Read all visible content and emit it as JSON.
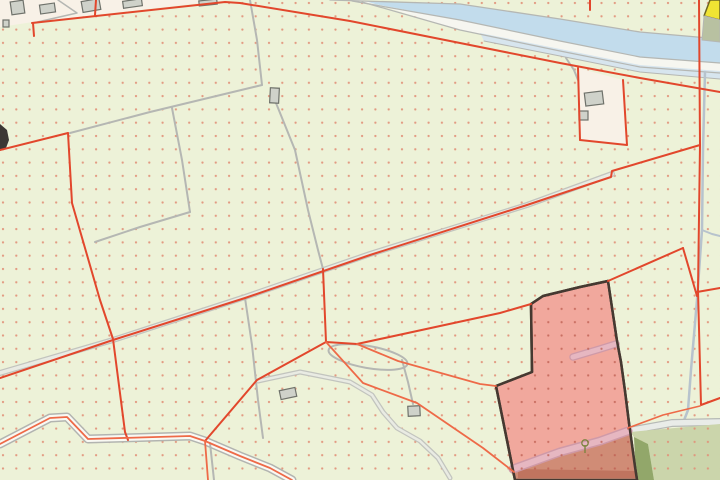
{
  "map": {
    "kind": "cadastral-map-view",
    "width": 720,
    "height": 480,
    "palette": {
      "bg": "#edf2d8",
      "dot": "#e29078",
      "dot_dark": "#bd5c4e",
      "red": "#e2472c",
      "red_thin": "#ee6a48",
      "gray": "#b5b7b3",
      "road_edge": "#c2c4be",
      "road_fill": "#e9ebe3",
      "canal": "#c2dcec",
      "canal2": "#d7e5ee",
      "towpath": "#f6f6f0",
      "farmyard": "#f8f1e7",
      "building_fill": "#cfd2ca",
      "building_edge": "#6f726b",
      "yellow": "#f0e433",
      "yellow_edge": "#6c6624",
      "olive": "#b8c1a1",
      "pink": "#f1a89d",
      "pink_edge": "#453931",
      "terracotta": "#d08c76",
      "terracotta_dark": "#bb6c58",
      "mauve": "#e6b7c1",
      "mauve_edge": "#cf9aa8",
      "pale_path": "#e9ece8",
      "pale_path_edge": "#b6bab6",
      "ditch": "#b7c3cd",
      "sage": "#cbd5ab",
      "sage_dark": "#92a76a",
      "stream_fill": "#f9f9f3",
      "stream_edge": "#b2b4b0",
      "black_feature": "#3b3734",
      "tree": "#7d8440"
    },
    "dot_grid": {
      "spacing": 13.3,
      "radius": 1.15
    },
    "layers": [
      {
        "name": "farmyard-top-left",
        "kind": "polygon",
        "pts": "0,0 228,0 33,22 0,27",
        "fill": "farmyard"
      },
      {
        "name": "farmyard-top-right",
        "kind": "polygon",
        "pts": "578,68 623,80 627,145 580,141",
        "fill": "farmyard"
      },
      {
        "name": "canal-water",
        "kind": "polygon",
        "pts": "330,0 460,4 560,19 640,32 720,39 720,63 640,57 560,41 460,20 352,0",
        "fill": "canal"
      },
      {
        "name": "canal-towpath",
        "kind": "polygon",
        "pts": "352,0 460,20 560,41 640,57 720,63 720,73 640,67 560,51 460,30 362,0",
        "fill": "towpath"
      },
      {
        "name": "canal-secondary-water",
        "kind": "polygon",
        "pts": "480,33 560,49 640,65 720,71 720,79 640,72 560,56 484,41",
        "fill": "canal2"
      },
      {
        "name": "canal-bank-line-north",
        "kind": "polyline",
        "pts": "330,0 460,4 560,19 640,32 720,39",
        "stroke": "gray",
        "w": 1.3
      },
      {
        "name": "canal-bank-line-south",
        "kind": "polyline",
        "pts": "352,1 460,20 560,41 640,57 720,63",
        "stroke": "gray",
        "w": 1.2
      },
      {
        "name": "towpath-edge-line",
        "kind": "polyline",
        "pts": "362,2 460,30 560,51 640,67 720,73",
        "stroke": "gray",
        "w": 1.2
      },
      {
        "name": "secondary-bank-line",
        "kind": "polyline",
        "pts": "484,41 560,56 640,72 720,79",
        "stroke": "gray",
        "w": 1
      },
      {
        "name": "road-main-casing",
        "kind": "polyline",
        "pts": "0,373 113,340 245,297 370,254 527,205 612,174",
        "stroke": "road_edge",
        "w": 6
      },
      {
        "name": "road-main",
        "kind": "polyline",
        "pts": "0,373 113,340 245,297 370,254 527,205 612,174",
        "stroke": "road_fill",
        "w": 3.5
      },
      {
        "name": "field-path-branch",
        "kind": "polyline",
        "pts": "245,298 252,345 258,400 263,438",
        "stroke": "gray",
        "w": 2
      },
      {
        "name": "field-line-diagonal",
        "kind": "polyline",
        "pts": "70,133 150,112 262,85",
        "stroke": "gray",
        "w": 2
      },
      {
        "name": "field-line-north",
        "kind": "polyline",
        "pts": "250,0 257,40 262,85",
        "stroke": "gray",
        "w": 2
      },
      {
        "name": "field-line-curve",
        "kind": "polyline",
        "pts": "276,103 295,150 308,210 318,250 323,269",
        "stroke": "gray",
        "w": 2
      },
      {
        "name": "field-line-vertical",
        "kind": "polyline",
        "pts": "172,108 182,160 190,212",
        "stroke": "gray",
        "w": 2
      },
      {
        "name": "field-line-southwest",
        "kind": "polyline",
        "pts": "190,212 140,227 95,242",
        "stroke": "gray",
        "w": 2
      },
      {
        "name": "farm-access-path",
        "kind": "polyline",
        "pts": "566,58 574,70 578,80",
        "stroke": "gray",
        "w": 2
      },
      {
        "name": "yard-path-line",
        "kind": "polyline",
        "pts": "58,0 77,13 33,23",
        "stroke": "gray",
        "w": 1.5
      },
      {
        "name": "loop-path",
        "kind": "ellipse",
        "cx": 368,
        "cy": 357,
        "rx": 40,
        "ry": 11,
        "rot": 10,
        "stroke": "gray",
        "w": 2
      },
      {
        "name": "s-path-casing",
        "kind": "polyline",
        "pts": "258,381 300,372 350,382 372,395 383,412 397,428 420,441 438,458 450,478",
        "stroke": "road_edge",
        "w": 5
      },
      {
        "name": "s-path",
        "kind": "polyline",
        "pts": "258,381 300,372 350,382 372,395 383,412 397,428 420,441 438,458 450,478",
        "stroke": "road_fill",
        "w": 2.5
      },
      {
        "name": "loop-branch-path",
        "kind": "polyline",
        "pts": "402,360 408,382 413,404",
        "stroke": "gray",
        "w": 2
      },
      {
        "name": "stream-casing",
        "kind": "polyline",
        "pts": "0,444 50,418 67,417 88,439 190,436 205,441 240,456 270,468 292,480",
        "stroke": "stream_edge",
        "w": 9
      },
      {
        "name": "stream",
        "kind": "polyline",
        "pts": "0,444 50,418 67,417 88,439 190,436 205,441 240,456 270,468 292,480",
        "stroke": "stream_fill",
        "w": 6
      },
      {
        "name": "stream-branch-path",
        "kind": "polyline",
        "pts": "210,443 214,480",
        "stroke": "gray",
        "w": 2
      },
      {
        "name": "ditch-east",
        "kind": "polyline",
        "pts": "705,72 703,150 702,230 697,300 691,370 688,410 683,423",
        "stroke": "ditch",
        "w": 2.5
      },
      {
        "name": "ditch-east-branch",
        "kind": "polyline",
        "pts": "702,230 712,234 720,236",
        "stroke": "ditch",
        "w": 2
      },
      {
        "name": "pale-path-casing",
        "kind": "polyline",
        "pts": "628,431 672,423 720,422",
        "stroke": "pale_path_edge",
        "w": 8
      },
      {
        "name": "pale-path",
        "kind": "polyline",
        "pts": "628,431 672,423 720,422",
        "stroke": "pale_path",
        "w": 5.5
      },
      {
        "name": "sage-area",
        "kind": "polygon",
        "pts": "630,432 720,424 720,480 654,480 648,444 634,437",
        "fill": "sage",
        "dots": "light"
      },
      {
        "name": "tree-wedge",
        "kind": "polygon",
        "pts": "634,437 648,444 654,480 636,480",
        "fill": "sage_dark"
      },
      {
        "name": "selected-parcel",
        "kind": "polygon",
        "pts": "531,304 543,296 580,287 608,281 617,341 621,362 625,391 629,423 635,467 637,480 515,480 496,386 532,372",
        "fill": "pink",
        "stroke": "pink_edge",
        "sw": 2.5,
        "interactable": true
      },
      {
        "name": "parcel-south-area",
        "kind": "polygon",
        "pts": "511,472 560,455 603,443 629,432 635,467 637,480 515,480",
        "fill": "terracotta"
      },
      {
        "name": "parcel-south-dark-strip",
        "kind": "polygon",
        "pts": "518,469 636,471 636,478 518,478",
        "fill": "terracotta_dark",
        "op": 0.75
      },
      {
        "name": "parcel-road-casing",
        "kind": "polyline",
        "pts": "513,469 560,452 600,441 628,431",
        "stroke": "mauve_edge",
        "w": 9
      },
      {
        "name": "parcel-road",
        "kind": "polyline",
        "pts": "513,469 560,452 600,441 628,431",
        "stroke": "mauve",
        "w": 6
      },
      {
        "name": "parcel-drive-casing",
        "kind": "polyline",
        "pts": "573,357 600,349 616,344",
        "stroke": "mauve_edge",
        "w": 7.5
      },
      {
        "name": "parcel-drive",
        "kind": "polyline",
        "pts": "573,357 600,349 616,344",
        "stroke": "mauve",
        "w": 5
      },
      {
        "name": "selected-parcel-dots",
        "kind": "polygon",
        "pts": "531,304 543,296 580,287 608,281 617,341 621,362 625,391 629,423 635,467 637,480 515,480 496,386 532,372",
        "fill": "@dotsDark",
        "stroke": "pink_edge",
        "sw": 2.5
      },
      {
        "name": "tree-symbol",
        "kind": "tree",
        "x": 585,
        "y": 447
      },
      {
        "name": "black-structure",
        "kind": "polygon",
        "pts": "0,124 7,130 9,140 6,148 0,151",
        "fill": "black_feature"
      },
      {
        "name": "building",
        "kind": "rect",
        "x": 11,
        "y": 1,
        "w": 13,
        "h": 13,
        "rot": -8
      },
      {
        "name": "building",
        "kind": "rect",
        "x": 40,
        "y": 4,
        "w": 15,
        "h": 9,
        "rot": -8
      },
      {
        "name": "building",
        "kind": "rect",
        "x": 3,
        "y": 20,
        "w": 6,
        "h": 7,
        "rot": 0
      },
      {
        "name": "building",
        "kind": "rect",
        "x": 82,
        "y": 0,
        "w": 18,
        "h": 11,
        "rot": -10
      },
      {
        "name": "building",
        "kind": "rect",
        "x": 123,
        "y": 0,
        "w": 19,
        "h": 7,
        "rot": -8
      },
      {
        "name": "building",
        "kind": "rect",
        "x": 199,
        "y": 0,
        "w": 18,
        "h": 5,
        "rot": -6
      },
      {
        "name": "building",
        "kind": "rect",
        "x": 270,
        "y": 88,
        "w": 9,
        "h": 15,
        "rot": 3
      },
      {
        "name": "building",
        "kind": "rect",
        "x": 585,
        "y": 92,
        "w": 18,
        "h": 13,
        "rot": -7
      },
      {
        "name": "building",
        "kind": "rect",
        "x": 579,
        "y": 111,
        "w": 9,
        "h": 9,
        "rot": 0
      },
      {
        "name": "building",
        "kind": "rect",
        "x": 408,
        "y": 406,
        "w": 12,
        "h": 10,
        "rot": -3
      },
      {
        "name": "building",
        "kind": "rect",
        "x": 280,
        "y": 389,
        "w": 16,
        "h": 9,
        "rot": -12
      },
      {
        "name": "parcel-boundary-canal-south",
        "kind": "polyline",
        "pts": "32,23 225,2 240,3 350,21 460,43 560,63 640,78 720,92",
        "stroke": "red",
        "w": 2
      },
      {
        "name": "parcel-boundary-top-stub",
        "kind": "polyline",
        "pts": "96,0 95,15",
        "stroke": "red",
        "w": 2
      },
      {
        "name": "parcel-boundary-west-in",
        "kind": "polyline",
        "pts": "0,150 68,133",
        "stroke": "red",
        "w": 2
      },
      {
        "name": "parcel-boundary-west-long",
        "kind": "polyline",
        "pts": "68,133 72,203 100,300 113,339 125,432 128,440",
        "stroke": "red",
        "w": 2
      },
      {
        "name": "parcel-boundary-yard-stub",
        "kind": "polyline",
        "pts": "33,23 34,36",
        "stroke": "red",
        "w": 2
      },
      {
        "name": "parcel-boundary-road-long",
        "kind": "polyline",
        "pts": "0,378 113,340 245,298 370,255 527,205 611,177 612,171 700,145",
        "stroke": "red",
        "w": 2
      },
      {
        "name": "parcel-boundary-mid-vertical",
        "kind": "polyline",
        "pts": "323,269 326,342",
        "stroke": "red",
        "w": 2
      },
      {
        "name": "parcel-boundary-to-stream",
        "kind": "polyline",
        "pts": "326,342 257,380 205,441",
        "stroke": "red",
        "w": 2
      },
      {
        "name": "parcel-boundary-to-parcel-top",
        "kind": "polyline",
        "pts": "326,342 357,344 500,313 531,304",
        "stroke": "red",
        "w": 2
      },
      {
        "name": "parcel-boundary-to-parcel-corner",
        "kind": "polyline",
        "pts": "357,344 398,361 480,384 496,386",
        "stroke": "red_thin",
        "w": 1.8
      },
      {
        "name": "parcel-boundary-diagonal-south",
        "kind": "polyline",
        "pts": "326,342 363,383 417,403 483,448 514,472",
        "stroke": "red_thin",
        "w": 1.8
      },
      {
        "name": "farmyard-boundary-west",
        "kind": "polyline",
        "pts": "578,68 580,140",
        "stroke": "red",
        "w": 2
      },
      {
        "name": "farmyard-boundary-south",
        "kind": "polyline",
        "pts": "580,140 627,145",
        "stroke": "red",
        "w": 2
      },
      {
        "name": "farmyard-boundary-east",
        "kind": "polyline",
        "pts": "627,145 623,80",
        "stroke": "red",
        "w": 2
      },
      {
        "name": "boundary-stub-canal",
        "kind": "polyline",
        "pts": "590,0 590,10",
        "stroke": "red",
        "w": 2
      },
      {
        "name": "parcel-boundary-east-long",
        "kind": "polyline",
        "pts": "699,0 700,145 698,290 701,405 720,398",
        "stroke": "red",
        "w": 2
      },
      {
        "name": "parcel-boundary-east-stub",
        "kind": "polyline",
        "pts": "697,292 720,288",
        "stroke": "red",
        "w": 2
      },
      {
        "name": "parcel-boundary-ne-1",
        "kind": "polyline",
        "pts": "608,281 683,248",
        "stroke": "red",
        "w": 2
      },
      {
        "name": "parcel-boundary-ne-2",
        "kind": "polyline",
        "pts": "683,248 697,296",
        "stroke": "red",
        "w": 2
      },
      {
        "name": "stream-boundary-line",
        "kind": "polyline",
        "pts": "0,444 50,418 67,417 88,439 190,436 205,441 240,456 270,468 292,480",
        "stroke": "red_thin",
        "w": 1.8
      },
      {
        "name": "stream-boundary-branch",
        "kind": "polyline",
        "pts": "205,441 208,480",
        "stroke": "red_thin",
        "w": 1.8
      },
      {
        "name": "path-boundary-southeast",
        "kind": "polyline",
        "pts": "628,428 663,415 700,406",
        "stroke": "red_thin",
        "w": 1.6
      },
      {
        "name": "classified-area-yellow",
        "kind": "polygon",
        "pts": "710,0 720,0 720,20 704,16",
        "fill": "yellow",
        "stroke": "yellow_edge",
        "sw": 1.5
      },
      {
        "name": "classified-area-olive",
        "kind": "polygon",
        "pts": "704,16 720,20 720,42 702,40",
        "fill": "olive",
        "stroke": "gray",
        "sw": 1
      }
    ]
  }
}
